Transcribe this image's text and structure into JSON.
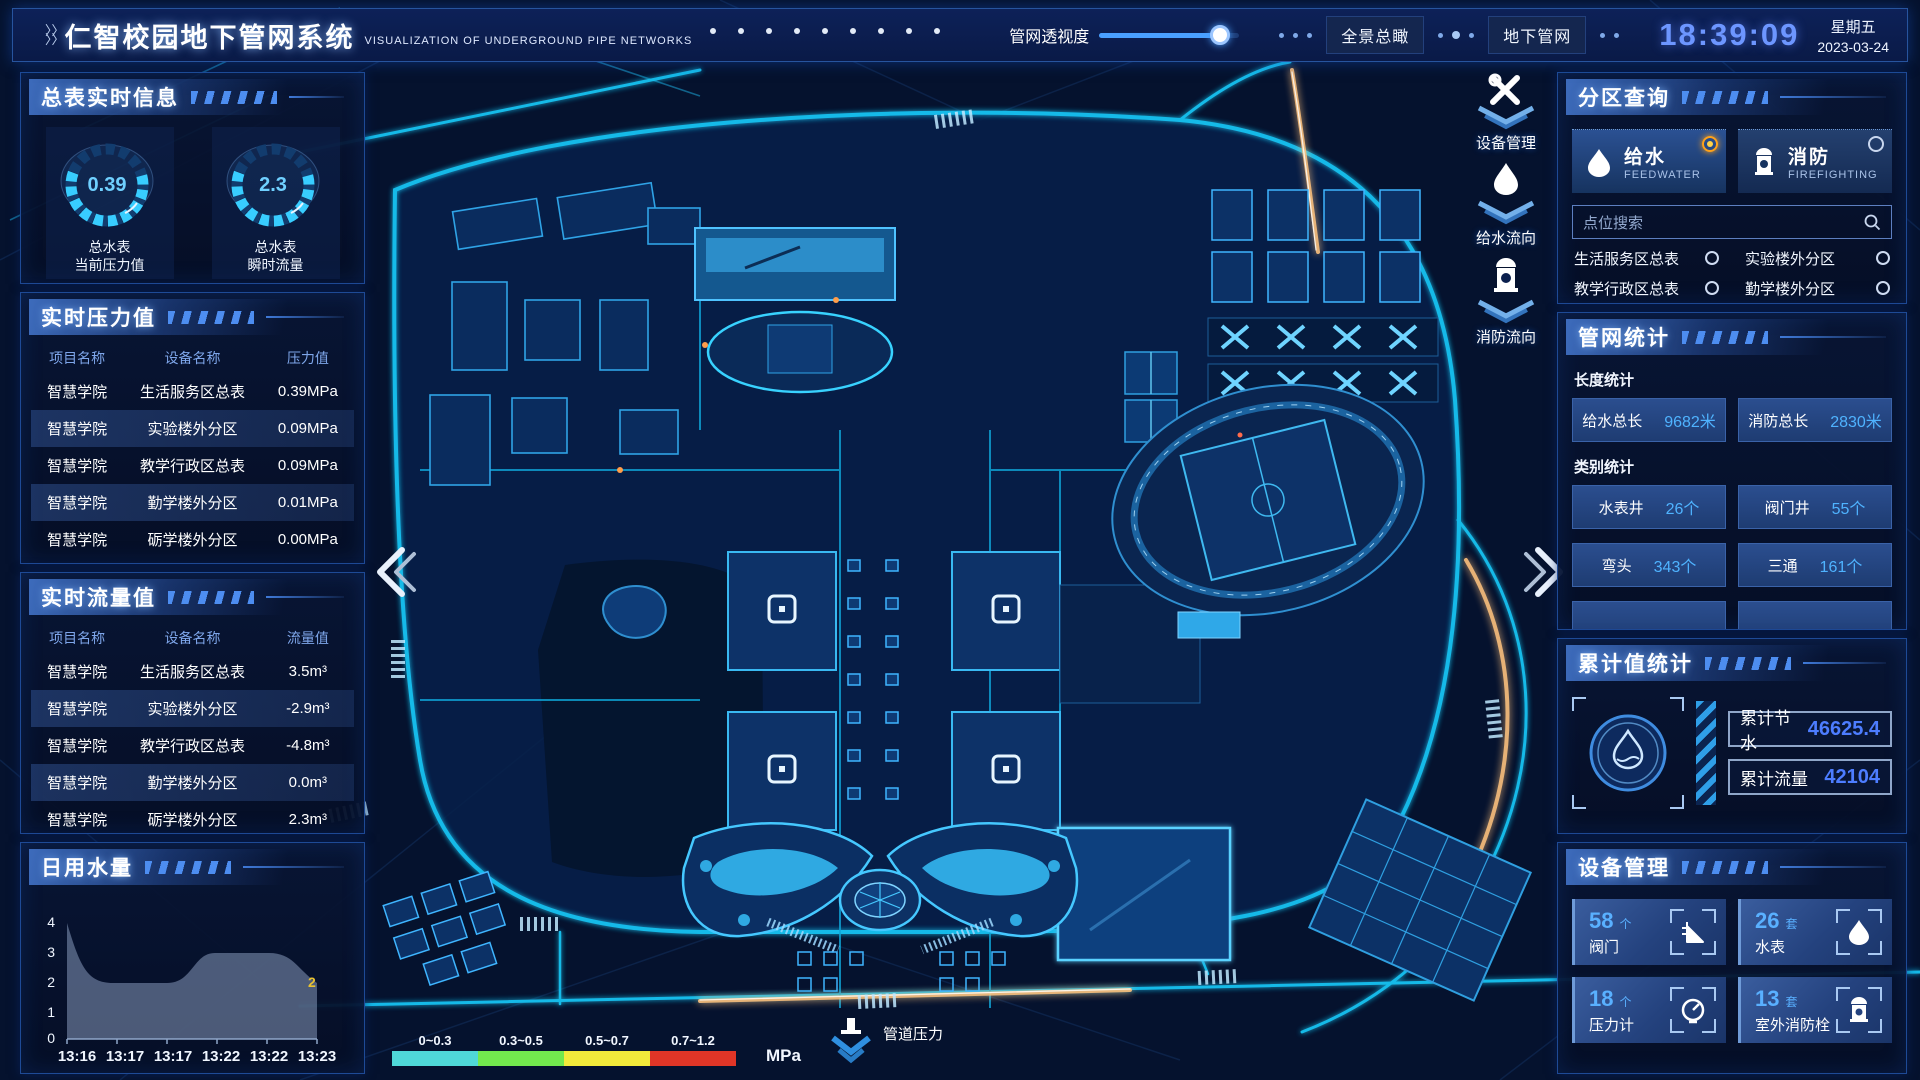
{
  "header": {
    "title": "仁智校园地下管网系统",
    "subtitle": "VISUALIZATION OF UNDERGROUND PIPE NETWORKS",
    "transparency_label": "管网透视度",
    "transparency_percent": 86,
    "btn_overview": "全景总瞰",
    "btn_underground": "地下管网",
    "clock": "18:39:09",
    "weekday": "星期五",
    "date": "2023-03-24"
  },
  "left": {
    "realtime_info": {
      "title": "总表实时信息",
      "gauges": [
        {
          "value": "0.39",
          "line1": "总水表",
          "line2": "当前压力值"
        },
        {
          "value": "2.3",
          "line1": "总水表",
          "line2": "瞬时流量"
        }
      ]
    },
    "pressure": {
      "title": "实时压力值",
      "headers": [
        "项目名称",
        "设备名称",
        "压力值"
      ],
      "rows": [
        [
          "智慧学院",
          "生活服务区总表",
          "0.39MPa"
        ],
        [
          "智慧学院",
          "实验楼外分区",
          "0.09MPa"
        ],
        [
          "智慧学院",
          "教学行政区总表",
          "0.09MPa"
        ],
        [
          "智慧学院",
          "勤学楼外分区",
          "0.01MPa"
        ],
        [
          "智慧学院",
          "砺学楼外分区",
          "0.00MPa"
        ]
      ]
    },
    "flow": {
      "title": "实时流量值",
      "headers": [
        "项目名称",
        "设备名称",
        "流量值"
      ],
      "rows": [
        [
          "智慧学院",
          "生活服务区总表",
          "3.5m³"
        ],
        [
          "智慧学院",
          "实验楼外分区",
          "-2.9m³"
        ],
        [
          "智慧学院",
          "教学行政区总表",
          "-4.8m³"
        ],
        [
          "智慧学院",
          "勤学楼外分区",
          "0.0m³"
        ],
        [
          "智慧学院",
          "砺学楼外分区",
          "2.3m³"
        ]
      ]
    },
    "daily_water": {
      "title": "日用水量"
    }
  },
  "chart_data": {
    "type": "area",
    "title": "日用水量",
    "x": [
      "13:16",
      "13:17",
      "13:17",
      "13:22",
      "13:22",
      "13:23"
    ],
    "values": [
      4,
      2,
      2,
      3,
      3,
      2
    ],
    "y_ticks": [
      "4",
      "3",
      "2",
      "1",
      "0"
    ],
    "ylim": [
      0,
      4
    ],
    "grid": false,
    "annotation": {
      "text": "2",
      "color": "#e8c231"
    },
    "area_color": "rgba(145,165,200,0.5)"
  },
  "map": {
    "actions": [
      "设备管理",
      "给水流向",
      "消防流向"
    ],
    "legend": {
      "ranges": [
        "0~0.3",
        "0.3~0.5",
        "0.5~0.7",
        "0.7~1.2"
      ],
      "colors": [
        "#4fd8d8",
        "#72e84e",
        "#f2ea3b",
        "#e03527"
      ],
      "unit": "MPa",
      "label": "管道压力"
    }
  },
  "right": {
    "zone_query": {
      "title": "分区查询",
      "feedwater": {
        "name": "给水",
        "en": "FEEDWATER",
        "selected": true
      },
      "firefighting": {
        "name": "消防",
        "en": "FIREFIGHTING",
        "selected": false
      },
      "search_placeholder": "点位搜索",
      "items": [
        "生活服务区总表",
        "实验楼外分区",
        "教学行政区总表",
        "勤学楼外分区",
        "砺学楼外分区",
        "宿舍区泵房"
      ]
    },
    "pipe_stats": {
      "title": "管网统计",
      "length_label": "长度统计",
      "length": [
        {
          "label": "给水总长",
          "value": "9682米"
        },
        {
          "label": "消防总长",
          "value": "2830米"
        }
      ],
      "category_label": "类别统计",
      "category": [
        {
          "label": "水表井",
          "value": "26个"
        },
        {
          "label": "阀门井",
          "value": "55个"
        },
        {
          "label": "弯头",
          "value": "343个"
        },
        {
          "label": "三通",
          "value": "161个"
        }
      ]
    },
    "cumulative": {
      "title": "累计值统计",
      "rows": [
        {
          "label": "累计节水",
          "value": "46625.4"
        },
        {
          "label": "累计流量",
          "value": "42104"
        }
      ]
    },
    "devices": {
      "title": "设备管理",
      "cards": [
        {
          "count": "58",
          "unit": "个",
          "label": "阀门"
        },
        {
          "count": "26",
          "unit": "套",
          "label": "水表"
        },
        {
          "count": "18",
          "unit": "个",
          "label": "压力计"
        },
        {
          "count": "13",
          "unit": "套",
          "label": "室外消防栓"
        }
      ]
    }
  }
}
